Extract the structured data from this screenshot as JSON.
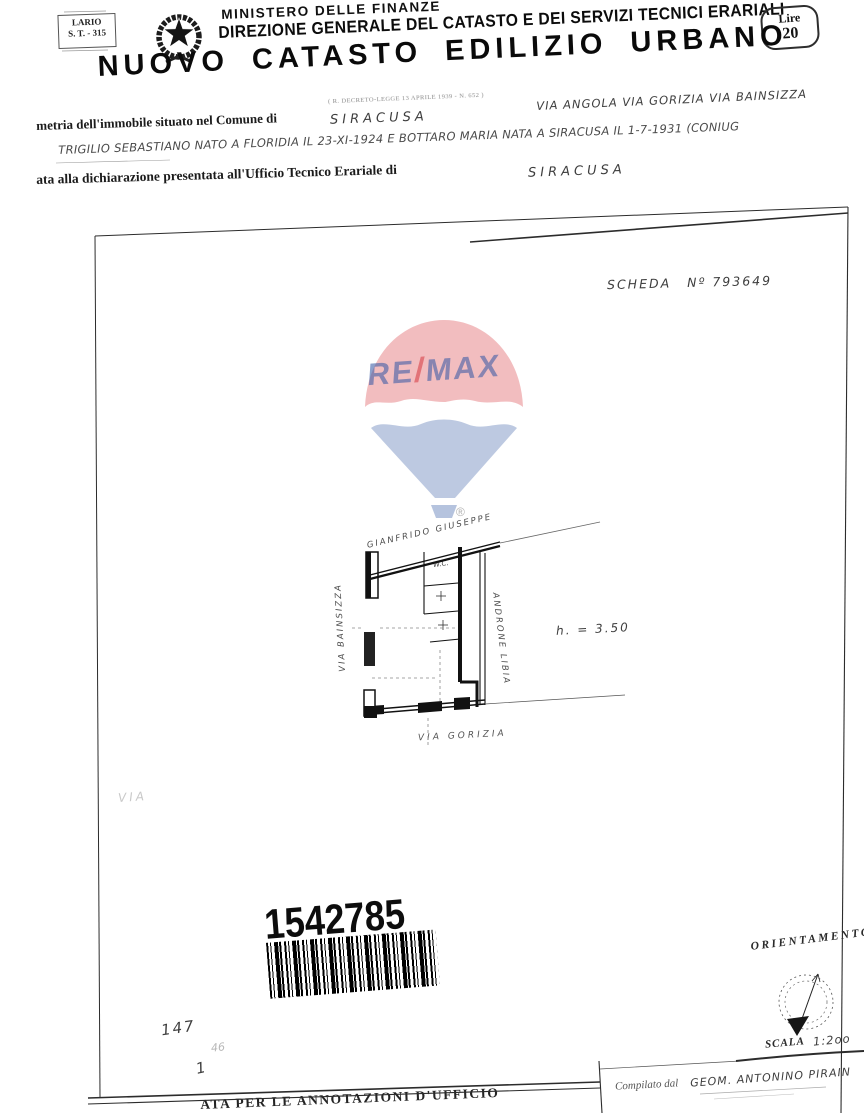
{
  "header": {
    "modulario": {
      "line1": "LARIO",
      "line2": "S. T. - 315"
    },
    "ministry_line1": "MINISTERO DELLE FINANZE",
    "ministry_line2": "DIREZIONE GENERALE DEL CATASTO E DEI SERVIZI TECNICI ERARIALI",
    "stamp": {
      "label": "Lire",
      "value": "20"
    },
    "title": "NUOVO CATASTO EDILIZIO URBANO",
    "subnote": "( R. DECRETO-LEGGE 13 APRILE 1939 - N. 652 )"
  },
  "form": {
    "line1_printed": "metria dell'immobile situato nel Comune di",
    "line1_value": "SIRACUSA",
    "line1_streets": "VIA ANGOLA VIA GORIZIA VIA BAINSIZZA",
    "line2_value": "TRIGILIO SEBASTIANO NATO A FLORIDIA IL 23-XI-1924 E BOTTARO MARIA NATA A SIRACUSA IL 1-7-1931 (CONIUG",
    "line3_printed": "ata alla dichiarazione presentata all'Ufficio Tecnico Erariale di",
    "line3_value": "SIRACUSA"
  },
  "sheet": {
    "scheda_label": "SCHEDA",
    "scheda_number": "Nº 793649"
  },
  "watermark": {
    "part_left": "RE",
    "part_slash": "/",
    "part_right": "MAX",
    "registered": "®",
    "red": "#D9464C",
    "blue": "#3B5BA5"
  },
  "plan": {
    "neighbor": "GIANFRIDO GIUSEPPE",
    "wc": "W.C.",
    "street_left": "VIA BAINSIZZA",
    "street_right": "ANDRONE LIBIA",
    "street_bottom": "VIA GORIZIA",
    "height_note": "h. = 3.50",
    "faint_street": "VIA"
  },
  "barcode": {
    "number": "1542785"
  },
  "footer": {
    "orientation": "ORIENTAMENTO",
    "scale_label": "SCALA",
    "scale_value": "1:2oo",
    "compiled_label": "Compilato dal",
    "compiled_value": "GEOM. ANTONINO PIRAIN",
    "annotations": "ATA PER LE ANNOTAZIONI D'UFFICIO",
    "margin_numbers": {
      "a": "147",
      "b": "46",
      "c": "1"
    }
  }
}
